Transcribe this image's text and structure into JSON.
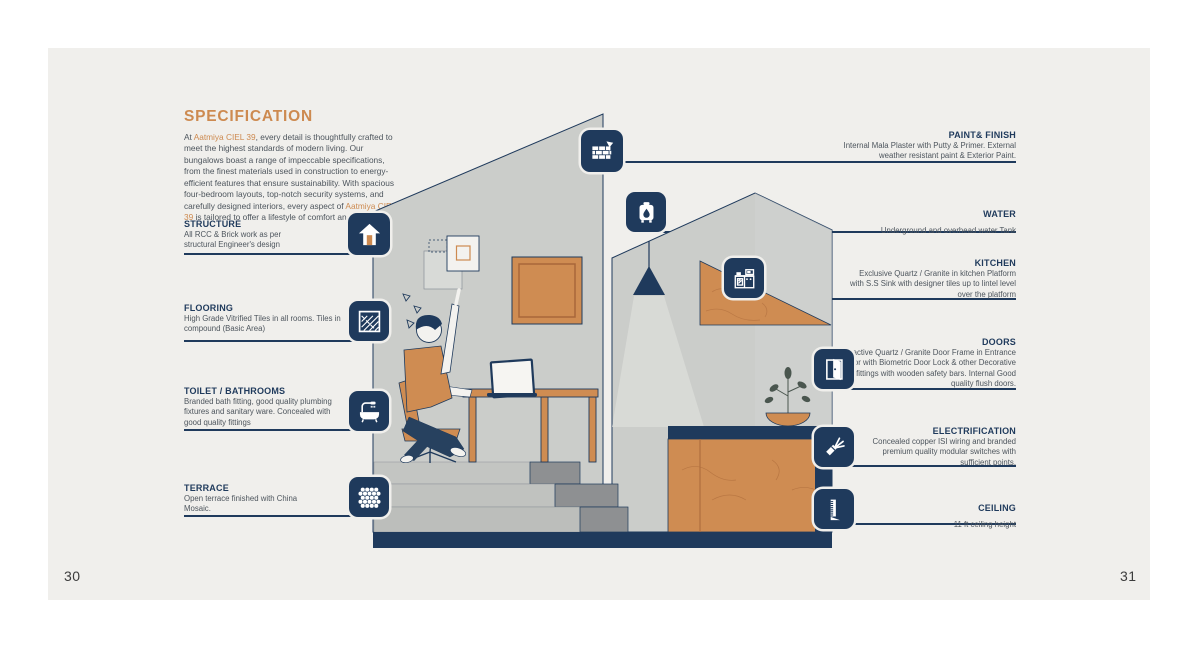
{
  "page": {
    "left_page_number": "30",
    "right_page_number": "31"
  },
  "colors": {
    "navy": "#1f3a5c",
    "orange": "#cd8a50",
    "wood": "#cf8c52",
    "paper": "#f0efec",
    "wall_gray": "#cbcdca"
  },
  "spec": {
    "title": "SPECIFICATION",
    "segments": [
      {
        "text": "At ",
        "accent": false
      },
      {
        "text": "Aatmiya CIEL 39",
        "accent": true
      },
      {
        "text": ", every detail is thoughtfully crafted to meet the highest standards of modern living. Our bungalows boast a range of impeccable specifications, from the finest materials used in construction to energy-efficient features that ensure sustainability. With spacious four-bedroom layouts, top-notch security systems, and carefully designed interiors, every aspect of ",
        "accent": false
      },
      {
        "text": "Aatmiya CIEL 39",
        "accent": true
      },
      {
        "text": " is tailored to offer a lifestyle of comfort and luxury.",
        "accent": false
      }
    ]
  },
  "left_items": [
    {
      "title": "STRUCTURE",
      "text": "All RCC & Brick work as per structural Engineer's design",
      "icon": "structure-arrow-icon"
    },
    {
      "title": "FLOORING",
      "text": "High Grade Vitrified Tiles in all rooms. Tiles in compound (Basic Area)",
      "icon": "herringbone-tiles-icon"
    },
    {
      "title": "TOILET / BATHROOMS",
      "text": "Branded bath fitting, good quality plumbing fixtures and sanitary ware. Concealed with good quality fittings",
      "icon": "bathtub-shower-icon"
    },
    {
      "title": "TERRACE",
      "text": "Open terrace finished with China Mosaic.",
      "icon": "mosaic-hex-icon"
    }
  ],
  "right_items": [
    {
      "title": "PAINT& FINISH",
      "text": "Internal Mala Plaster with Putty & Primer. External weather resistant paint & Exterior Paint.",
      "icon": "brick-trowel-icon"
    },
    {
      "title": "WATER",
      "text": "Underground and overhead water Tank",
      "icon": "water-tank-icon"
    },
    {
      "title": "KITCHEN",
      "text": "Exclusive Quartz / Granite in kitchen Platform with S.S Sink with designer tiles up to lintel level over the platform",
      "icon": "kitchen-counter-icon"
    },
    {
      "title": "DOORS",
      "text": "Attractive Quartz / Granite Door Frame in Entrance Door with Biometric Door Lock & other Decorative fittings with wooden safety bars. Internal Good quality flush doors.",
      "icon": "open-door-icon"
    },
    {
      "title": "ELECTRIFICATION",
      "text": "Concealed copper ISI wiring and branded premium quality modular switches with sufficient points.",
      "icon": "stripped-wire-icon"
    },
    {
      "title": "CEILING",
      "text": "11 ft ceiling height",
      "icon": "ruler-height-icon"
    }
  ]
}
